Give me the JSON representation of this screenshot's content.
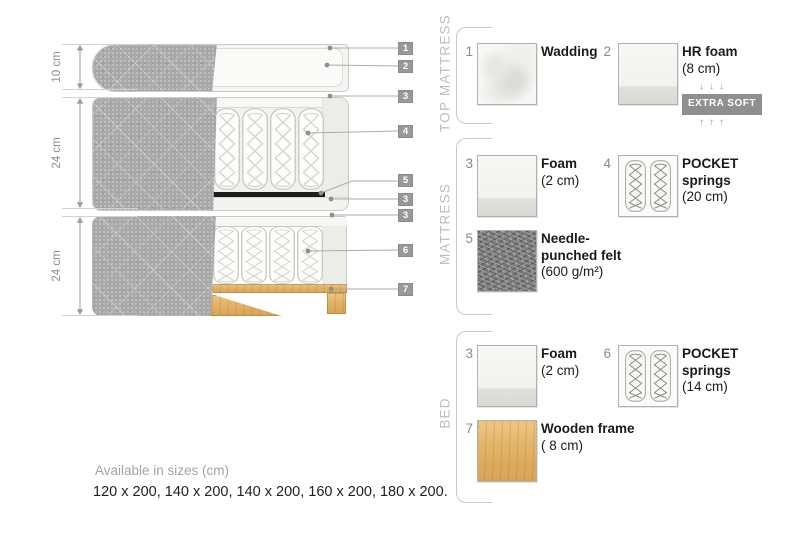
{
  "diagram": {
    "dimensions": [
      "10 cm",
      "24 cm",
      "24 cm"
    ],
    "callouts": [
      "1",
      "2",
      "3",
      "4",
      "5",
      "3",
      "3",
      "6",
      "7"
    ]
  },
  "legend": {
    "sections": [
      {
        "title": "TOP MATTRESS",
        "items": [
          {
            "num": "1",
            "name": "Wadding",
            "detail": ""
          },
          {
            "num": "2",
            "name": "HR foam",
            "detail": "(8 cm)",
            "arrows_down": "↓↓↓",
            "badge": "EXTRA SOFT",
            "arrows_up": "↑↑↑"
          }
        ]
      },
      {
        "title": "MATTRESS",
        "items": [
          {
            "num": "3",
            "name": "Foam",
            "detail": "(2 cm)"
          },
          {
            "num": "4",
            "name": "POCKET springs",
            "detail": "(20 cm)"
          },
          {
            "num": "5",
            "name": "Needle-punched felt",
            "detail": "(600 g/m²)"
          }
        ]
      },
      {
        "title": "BED",
        "items": [
          {
            "num": "3",
            "name": "Foam",
            "detail": "(2 cm)"
          },
          {
            "num": "6",
            "name": "POCKET springs",
            "detail": "(14 cm)"
          },
          {
            "num": "7",
            "name": "Wooden frame",
            "detail": "( 8  cm)"
          }
        ]
      }
    ]
  },
  "footer": {
    "title": "Available in sizes (cm)",
    "sizes": "120 x 200, 140 x 200, 140 x 200, 160 x 200, 180 x 200."
  },
  "colors": {
    "fabric_gray": "#a9a9a9",
    "callout_bg": "#999997",
    "badge_bg": "#8f8f8f",
    "wood": "#e0af62",
    "felt": "#787878",
    "felt_black_layer": "#1d1d1d"
  }
}
